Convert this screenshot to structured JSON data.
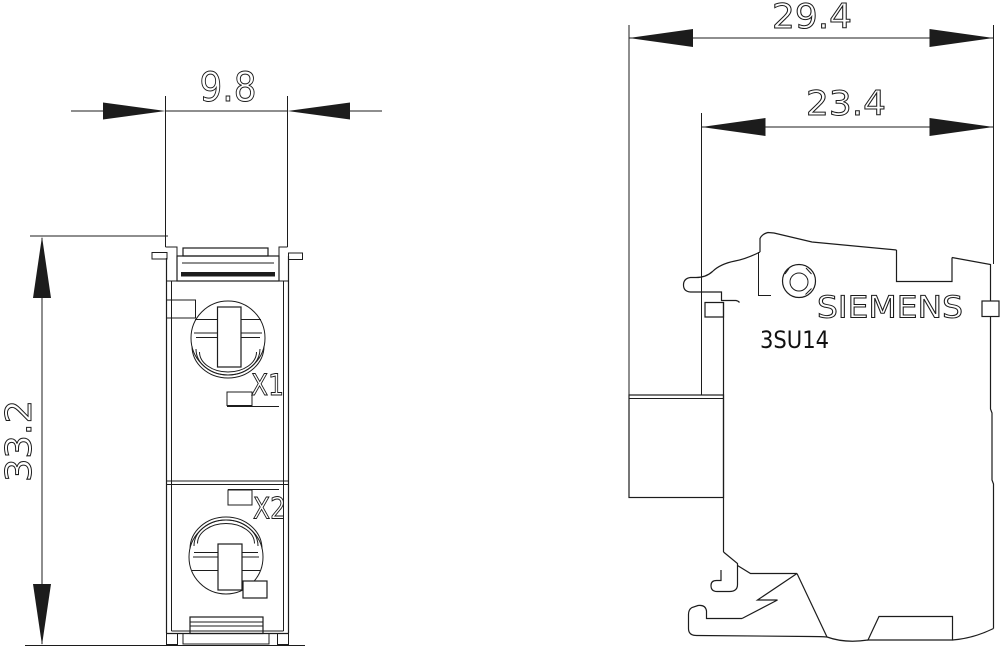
{
  "page": {
    "background": "#ffffff",
    "line_color": "#1c1c1c"
  },
  "front_view": {
    "width_dim": "9.8",
    "height_dim": "33.2",
    "terminal_1": "X1",
    "terminal_2": "X2"
  },
  "side_view": {
    "overall_depth_dim": "29.4",
    "inner_depth_dim": "23.4",
    "brand": "SIEMENS",
    "model": "3SU14"
  }
}
